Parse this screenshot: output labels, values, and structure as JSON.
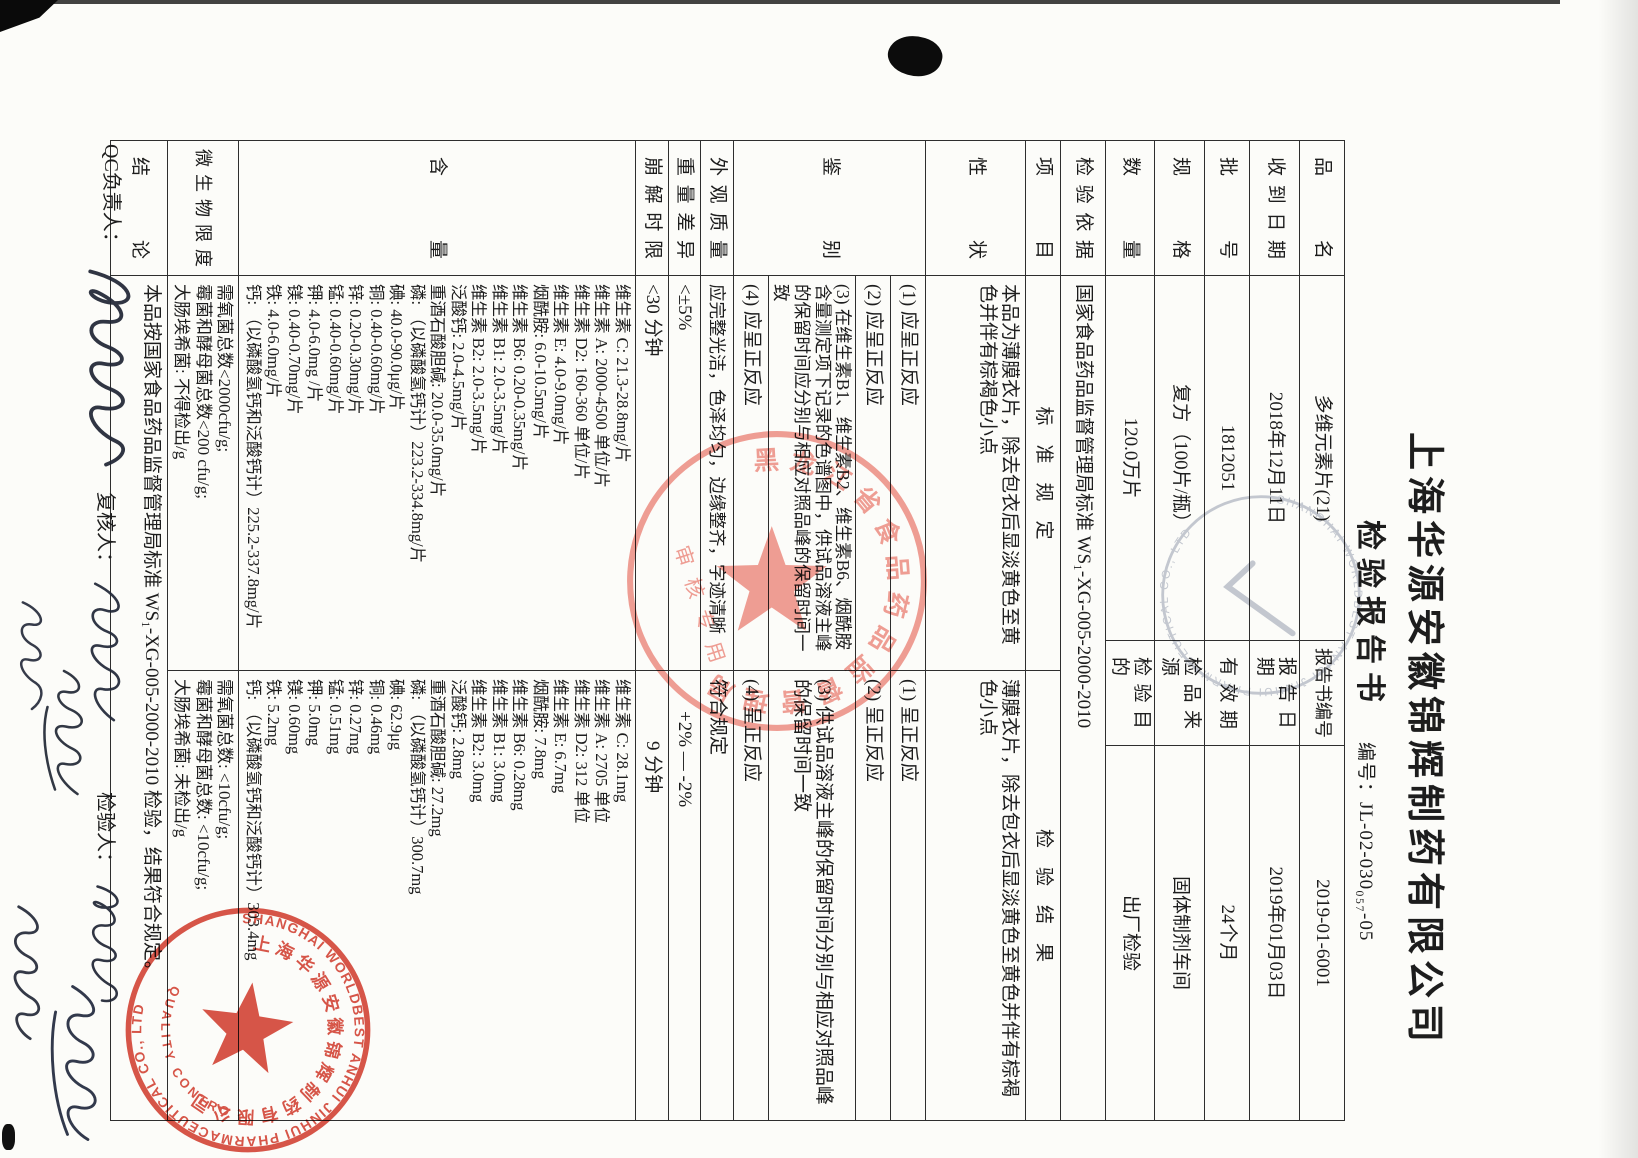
{
  "page": {
    "company": "上海华源安徽锦辉制药有限公司",
    "title": "检验报告书",
    "doc_no_label": "编号：",
    "doc_no": "JL-02-030₀₅₇-05"
  },
  "header_table": {
    "rows": [
      {
        "l1": "品　名",
        "v1": "多维元素片(21)",
        "l2": "报告书编号",
        "v2": "2019-01-6001"
      },
      {
        "l1": "收到日期",
        "v1": "2018年12月11日",
        "l2": "报告日期",
        "v2": "2019年01月03日"
      },
      {
        "l1": "批　号",
        "v1": "1812051",
        "l2": "有效期",
        "v2": "24个月"
      },
      {
        "l1": "规　格",
        "v1": "复方（100片/瓶）",
        "l2": "检品来源",
        "v2": "固体制剂车间"
      },
      {
        "l1": "数　量",
        "v1": "120.0万片",
        "l2": "检验目的",
        "v2": "出厂检验"
      },
      {
        "l1": "检验依据",
        "v1": "国家食品药品监督管理局标准 WS₁-XG-005-2000-2010"
      }
    ]
  },
  "main_table": {
    "headers": {
      "item": "项　目",
      "standard": "标　准　规　定",
      "result": "检　验　结　果"
    },
    "xingzhuang": {
      "label": "性　状",
      "standard": "本品为薄膜衣片，除去包衣后显淡黄色至黄色并伴有棕褐色小点",
      "result": "薄膜衣片，除去包衣后显淡黄色至黄色并伴有棕褐色小点"
    },
    "jianbie": {
      "label": "鉴　别",
      "std": [
        "(1) 应呈正反应",
        "(2) 应呈正反应",
        "(3) 在维生素B1、维生素B2、维生素B6、烟酰胺含量测定项下记录的色谱图中，供试品溶液主峰的保留时间应分别与相应对照品峰的保留时间一致",
        "(4) 应呈正反应"
      ],
      "res": [
        "(1) 呈正反应",
        "(2) 呈正反应",
        "(3) 供试品溶液主峰的保留时间分别与相应对照品峰的保留时间一致",
        "(4) 呈正反应"
      ]
    },
    "waiguan": {
      "label": "外观质量",
      "standard": "应完整光洁，色泽均匀，边缘整齐，字迹清晰",
      "result": "符合规定"
    },
    "zhongliang": {
      "label": "重量差异",
      "standard": "<±5%",
      "result": "+2% — -2%"
    },
    "bengjie": {
      "label": "崩解时限",
      "standard": "<30 分钟",
      "result": "9 分钟"
    },
    "hanliang": {
      "label": "含　量",
      "standards": [
        "维生素 C: 21.3-28.8mg/片",
        "维生素 A: 2000-4500 单位/片",
        "维生素 D2: 160-360 单位/片",
        "维生素 E: 4.0-9.0mg/片",
        "烟酰胺: 6.0-10.5mg/片",
        "维生素 B6: 0.20-0.35mg/片",
        "维生素 B1: 2.0-3.5mg/片",
        "维生素 B2: 2.0-3.5mg/片",
        "泛酸钙: 2.0-4.5mg/片",
        "重酒石酸胆碱: 20.0-35.0mg/片",
        "磷: （以磷酸氢钙计）223.2-334.8mg/片",
        "碘: 40.0-90.0μg/片",
        "铜: 0.40-0.60mg/片",
        "锌: 0.20-0.30mg/片",
        "锰: 0.40-0.60mg/片",
        "钾: 4.0-6.0mg /片",
        "镁: 0.40-0.70mg/片",
        "铁: 4.0-6.0mg/片",
        "钙: （以磷酸氢钙和泛酸钙计）225.2-337.8mg/片"
      ],
      "results": [
        "维生素 C: 28.1mg",
        "维生素 A: 2705 单位",
        "维生素 D2: 312 单位",
        "维生素 E: 6.7mg",
        "烟酰胺: 7.8mg",
        "维生素 B6: 0.28mg",
        "维生素 B1: 3.0mg",
        "维生素 B2: 3.0mg",
        "泛酸钙: 2.8mg",
        "重酒石酸胆碱: 27.2mg",
        "磷: （以磷酸氢钙计）300.7mg",
        "碘: 62.9μg",
        "铜: 0.46mg",
        "锌: 0.27mg",
        "锰: 0.51mg",
        "钾: 5.0mg",
        "镁: 0.60mg",
        "铁: 5.2mg",
        "钙: （以磷酸氢钙和泛酸钙计）303.4mg"
      ]
    },
    "weishengwu": {
      "label": "微生物限度",
      "std": [
        "需氧菌总数<2000cfu/g;",
        "霉菌和酵母菌总数<200 cfu/g;",
        "大肠埃希菌: 不得检出/g"
      ],
      "res": [
        "需氧菌总数: <10cfu/g;",
        "霉菌和酵母菌总数: <10cfu/g;",
        "大肠埃希菌: 未检出/g"
      ]
    },
    "jielun": {
      "label": "结　论",
      "text": "本品按国家食品药品监督管理局标准 WS₁-XG-005-2000-2010 检验，结果符合规定。"
    }
  },
  "footer": {
    "qc_label": "QC负责人：",
    "review_label": "复核人：",
    "inspector_label": "检验人："
  },
  "stamps": {
    "company_seal": {
      "ring_en": "SHANGHAI WORLDBEST ANHUI JINHUI PHARMACEUTICAL CO., LTD",
      "bottom_en": "QUALITY CONTROL",
      "ring_cn": "上海华源安徽锦辉制药有限公司",
      "color": "#d6493c"
    },
    "province_seal": {
      "ring_cn": "黑龙江省食品药品监督管理局",
      "color": "#ef8e85"
    },
    "faint_seal": {
      "ring_en": "SHANGHAI WORLDBEST ANHUI JINHUI PHARMACEUTICAL CO., LTD",
      "color": "#8d96aa"
    }
  }
}
